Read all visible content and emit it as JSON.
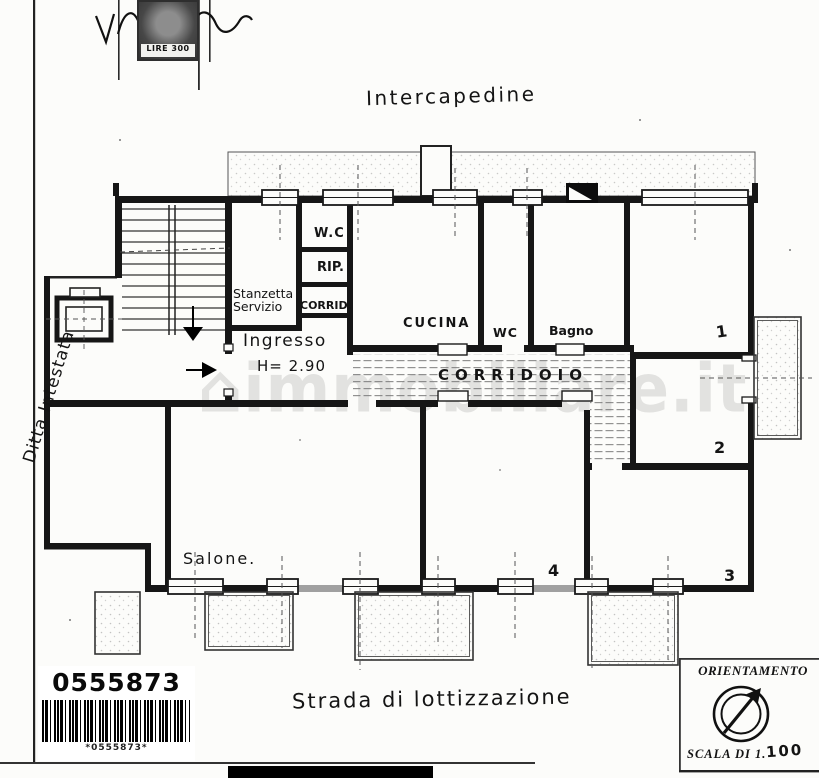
{
  "stamp": {
    "value": "LIRE 300"
  },
  "plan": {
    "area_label_top": "Intercapedine",
    "owner_label": "Ditta Intestata",
    "street_label": "Strada di lottizzazione",
    "rooms": {
      "wc_top": "W.C",
      "rip": "RIP.",
      "stanzetta_line1": "Stanzetta",
      "stanzetta_line2": "Servizio",
      "corrid_small": "CORRID.",
      "ingresso": "Ingresso",
      "ingresso_height": "H= 2.90",
      "cucina": "CUCINA",
      "wc": "WC",
      "bagno": "Bagno",
      "corridoio": "CORRIDOIO",
      "salone": "Salone.",
      "room1": "1",
      "room2": "2",
      "room3": "3",
      "room4": "4"
    }
  },
  "watermark": {
    "house_icon": "⌂",
    "text": "immobiliare.it"
  },
  "footer": {
    "barcode_number": "0555873",
    "barcode_caption": "*0555873*",
    "orientation_title": "ORIENTAMENTO",
    "scale_label": "SCALA DI 1.",
    "scale_value": "100"
  }
}
